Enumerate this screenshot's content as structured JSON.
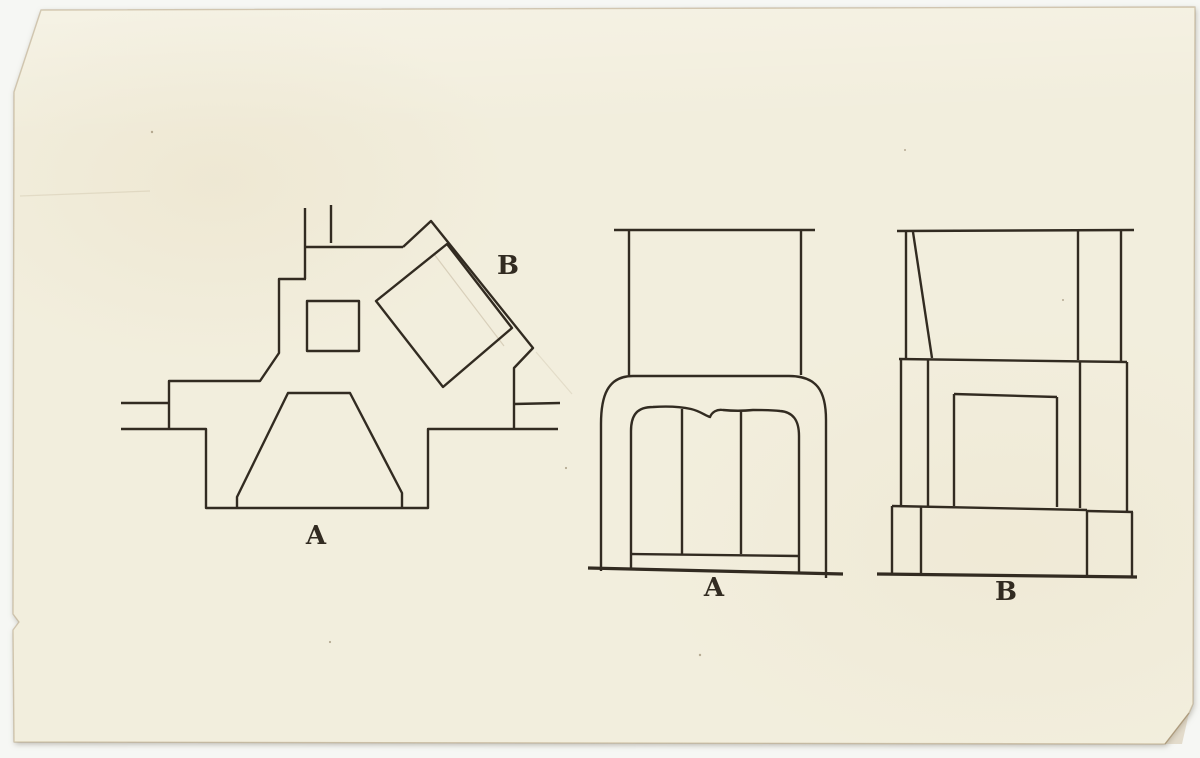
{
  "labels": {
    "plan_a": "A",
    "plan_b": "B",
    "elevation_a": "A",
    "elevation_b": "B"
  },
  "colors": {
    "backdrop": "#f6f7f4",
    "paper": "#f2eedd",
    "paper_edge": "#e9dfc5",
    "ink": "#322b21"
  }
}
